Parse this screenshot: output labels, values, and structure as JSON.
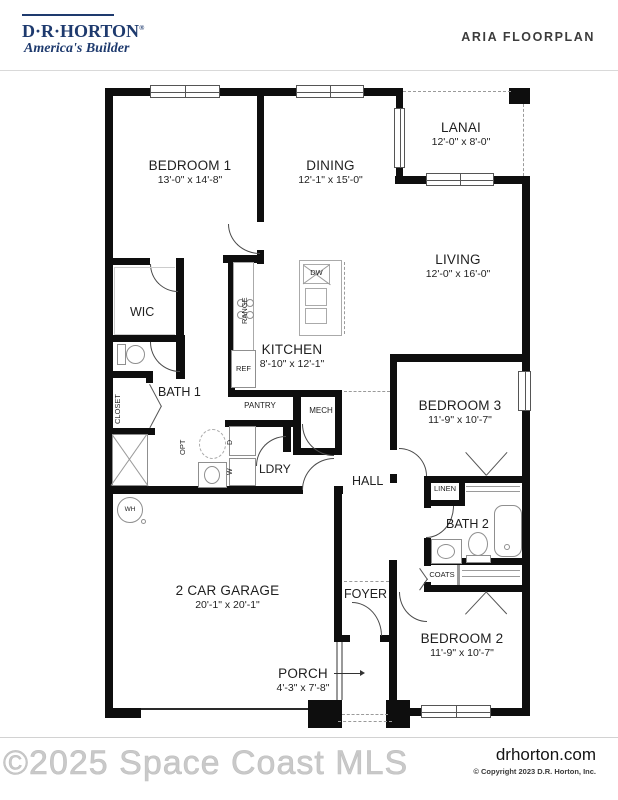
{
  "header": {
    "logo_title": "D·R·HORTON",
    "logo_reg": "®",
    "logo_tagline": "America's Builder",
    "plan_title": "ARIA FLOORPLAN"
  },
  "rooms": {
    "bedroom1": {
      "name": "BEDROOM 1",
      "dims": "13'-0\" x 14'-8\""
    },
    "dining": {
      "name": "DINING",
      "dims": "12'-1\" x 15'-0\""
    },
    "lanai": {
      "name": "LANAI",
      "dims": "12'-0\" x 8'-0\""
    },
    "living": {
      "name": "LIVING",
      "dims": "12'-0\" x 16'-0\""
    },
    "kitchen": {
      "name": "KITCHEN",
      "dims": "8'-10\" x 12'-1\""
    },
    "bedroom3": {
      "name": "BEDROOM 3",
      "dims": "11'-9\" x 10'-7\""
    },
    "bedroom2": {
      "name": "BEDROOM 2",
      "dims": "11'-9\" x 10'-7\""
    },
    "garage": {
      "name": "2 CAR GARAGE",
      "dims": "20'-1\" x 20'-1\""
    },
    "porch": {
      "name": "PORCH",
      "dims": "4'-3\" x 7'-8\""
    },
    "wic": {
      "name": "WIC"
    },
    "bath1": {
      "name": "BATH 1"
    },
    "bath2": {
      "name": "BATH 2"
    },
    "hall": {
      "name": "HALL"
    },
    "foyer": {
      "name": "FOYER"
    },
    "ldry": {
      "name": "LDRY"
    }
  },
  "small_labels": {
    "range": "RANGE",
    "ref": "REF",
    "dw": "DW",
    "pantry": "PANTRY",
    "mech": "MECH",
    "closet": "CLOSET",
    "opt": "OPT",
    "linen": "LINEN",
    "coats": "COATS",
    "wh": "WH",
    "washer": "W",
    "dryer": "D"
  },
  "footer": {
    "watermark": "©2025 Space Coast MLS",
    "website": "drhorton.com",
    "copyright": "© Copyright 2023 D.R. Horton, Inc."
  },
  "colors": {
    "brand_navy": "#1e3a6e",
    "wall_black": "#0e0e0e",
    "divider_gray": "#d9d9d9",
    "watermark_gray": "#c9c9c9"
  }
}
